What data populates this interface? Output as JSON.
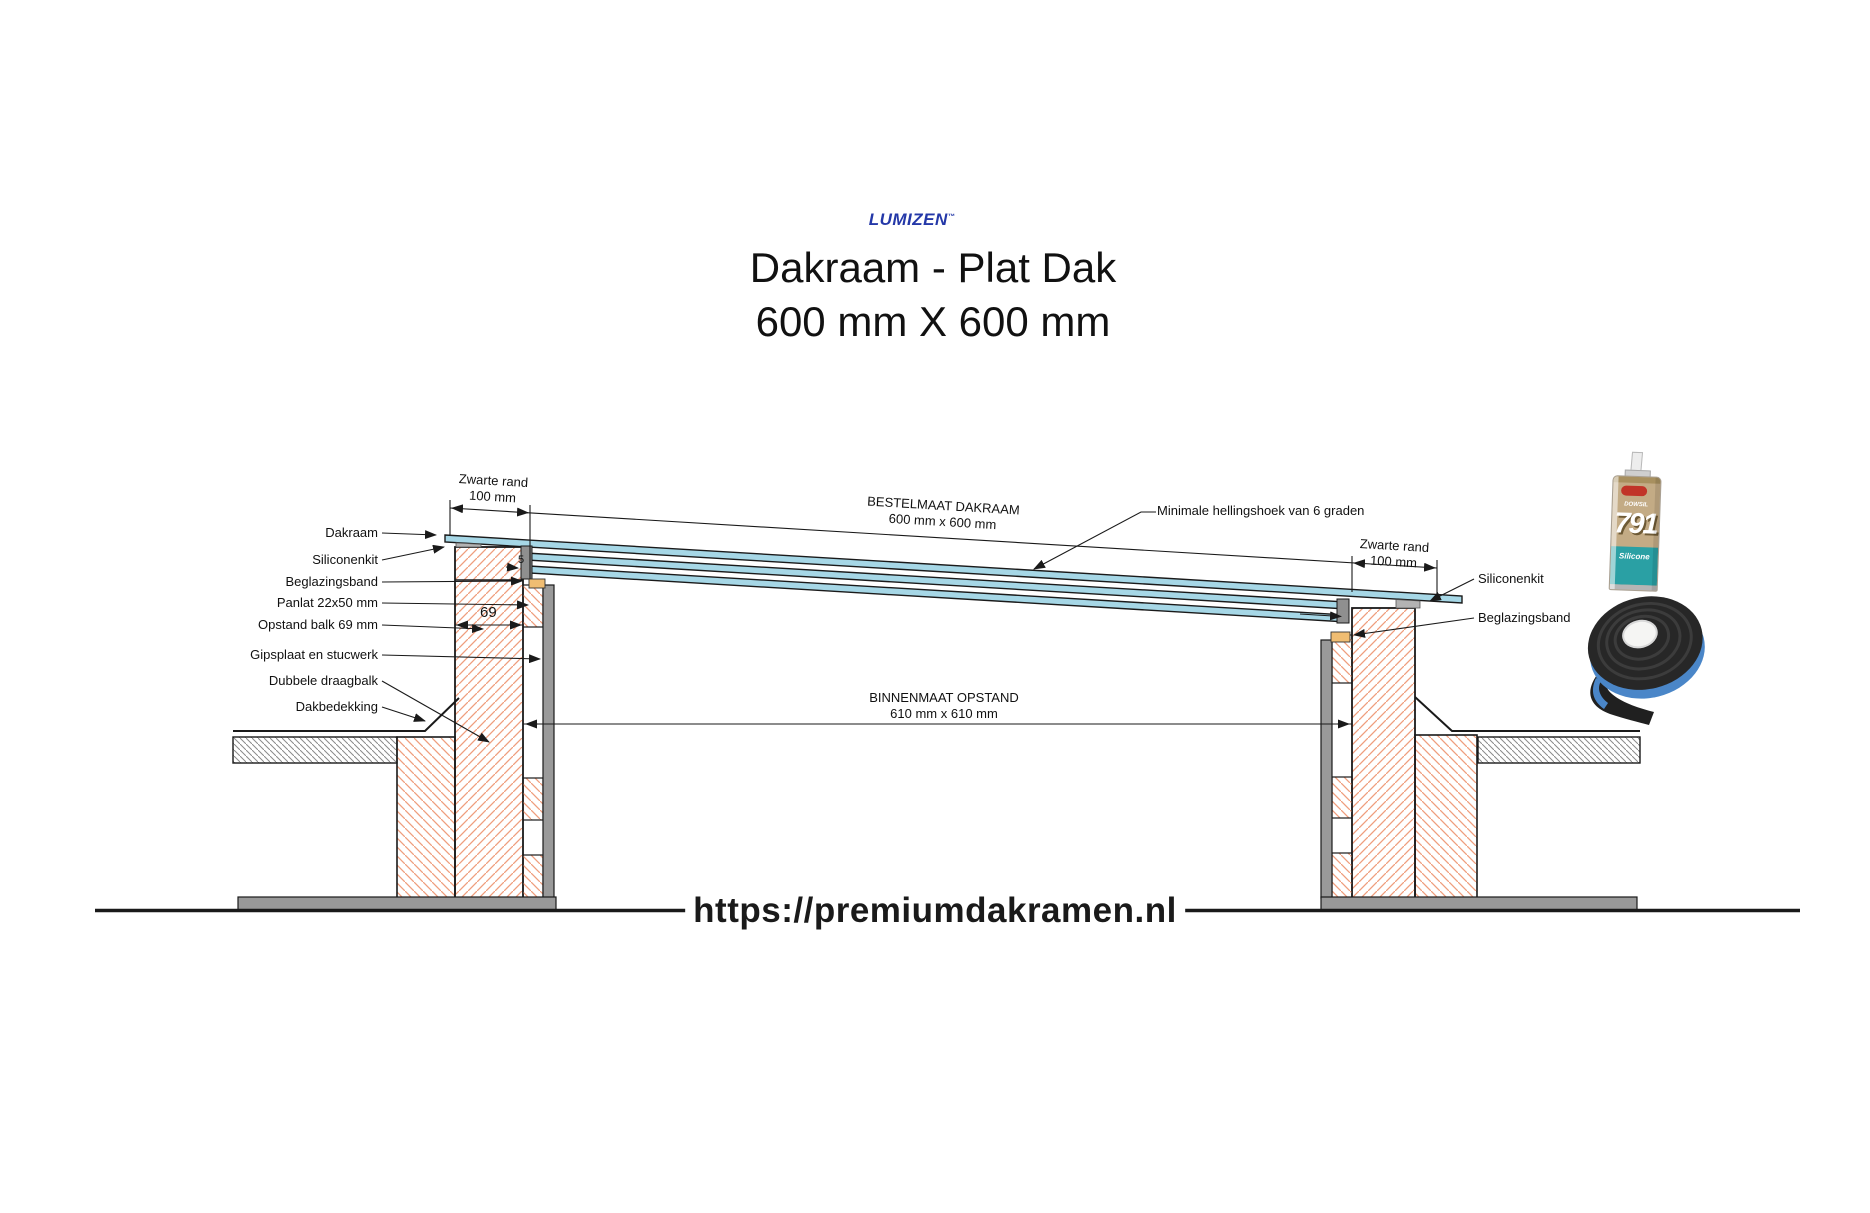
{
  "header": {
    "logo": "LUMIZEN",
    "logo_tm": "™",
    "title_line1": "Dakraam - Plat Dak",
    "title_line2": "600 mm X 600 mm"
  },
  "labels_left": [
    "Dakraam",
    "Siliconenkit",
    "Beglazingsband",
    "Panlat 22x50 mm",
    "Opstand balk 69 mm",
    "Gipsplaat en stucwerk",
    "Dubbele draagbalk",
    "Dakbedekking"
  ],
  "labels_right": {
    "siliconenkit": "Siliconenkit",
    "beglazingsband": "Beglazingsband"
  },
  "dimensions": {
    "zwarte_rand_left_line1": "Zwarte rand",
    "zwarte_rand_left_line2": "100 mm",
    "zwarte_rand_right_line1": "Zwarte rand",
    "zwarte_rand_right_line2": "100 mm",
    "bestelmaat_line1": "BESTELMAAT DAKRAAM",
    "bestelmaat_line2": "600 mm x 600 mm",
    "binnenmaat_line1": "BINNENMAAT OPSTAND",
    "binnenmaat_line2": "610 mm x 610 mm",
    "hellingshoek": "Minimale hellingshoek van 6 graden",
    "opstand_balk_breedte": "69",
    "glas_naad": "5"
  },
  "products": {
    "sealant": {
      "brand": "DOWSIL",
      "number": "791",
      "type": "Silicone"
    }
  },
  "footer": {
    "url": "https://premiumdakramen.nl"
  },
  "colors": {
    "glass_blue": "#a6d7e6",
    "wood_hatch": "#ef9e7d",
    "logo_blue": "#2438a8",
    "beglazingsband_orange": "#f0bd72",
    "tape_liner_blue": "#4a86c8",
    "sealant_teal": "#2aa0a4",
    "line_dark": "#1a1a1a"
  }
}
